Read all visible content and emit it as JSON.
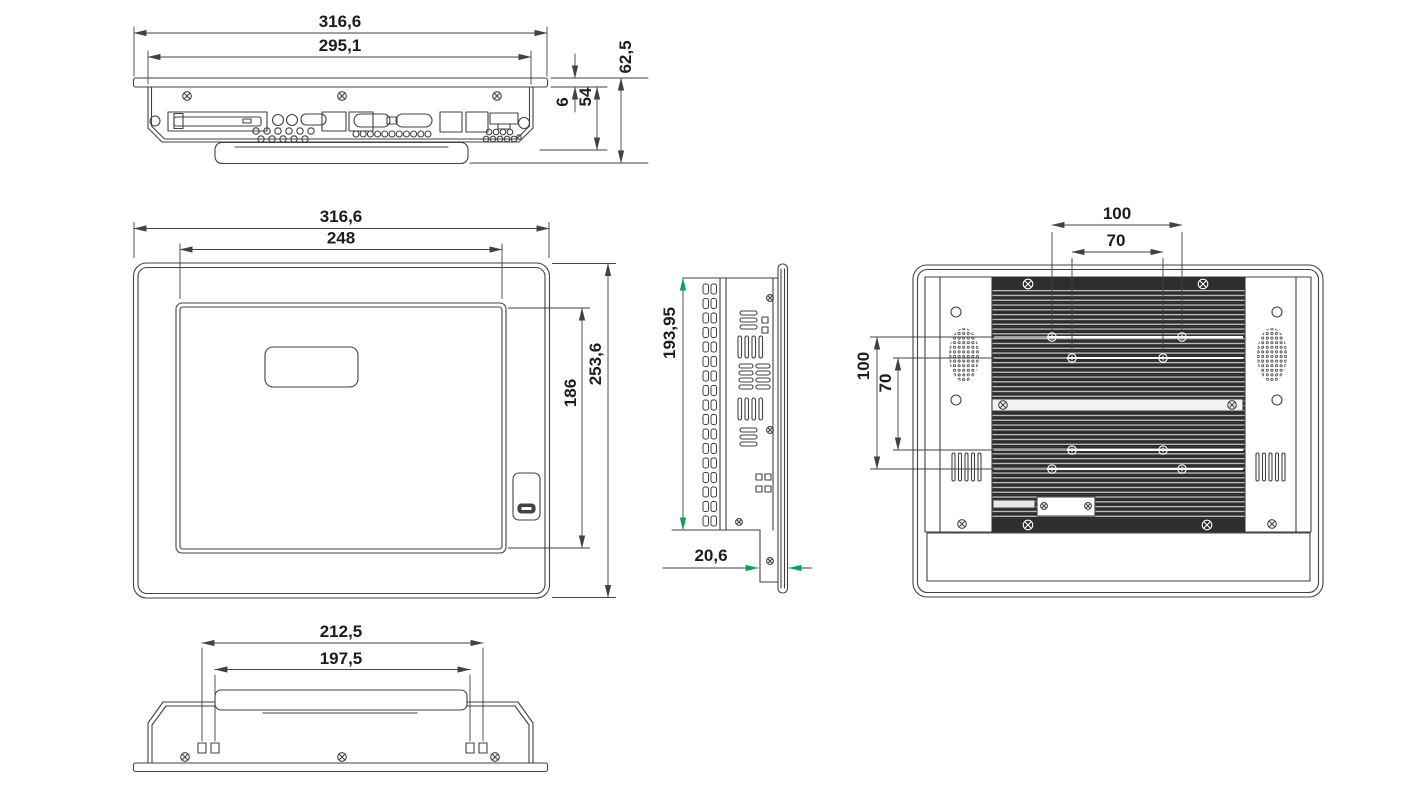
{
  "title": "panel-pc-dimension-drawing",
  "colors": {
    "line": "#424242",
    "text": "#1c1c1c",
    "green_arrow": "#00a651",
    "heatsink_dark": "#2e2e2e",
    "fin_light": "#d9d9d9",
    "background": "#ffffff"
  },
  "views": {
    "top": {
      "w_outer": "316,6",
      "w_inner": "295,1",
      "d_bezel": "6",
      "d_body": "54",
      "d_total": "62,5"
    },
    "front": {
      "w_outer": "316,6",
      "w_display": "248",
      "h_display": "186",
      "h_outer": "253,6"
    },
    "side": {
      "h_cutout": "193,95",
      "d_mount": "20,6"
    },
    "rear": {
      "vesa_w100": "100",
      "vesa_w70": "70",
      "vesa_h100": "100",
      "vesa_h70": "70"
    },
    "bottom": {
      "w_outer": "212,5",
      "w_inner": "197,5"
    }
  }
}
